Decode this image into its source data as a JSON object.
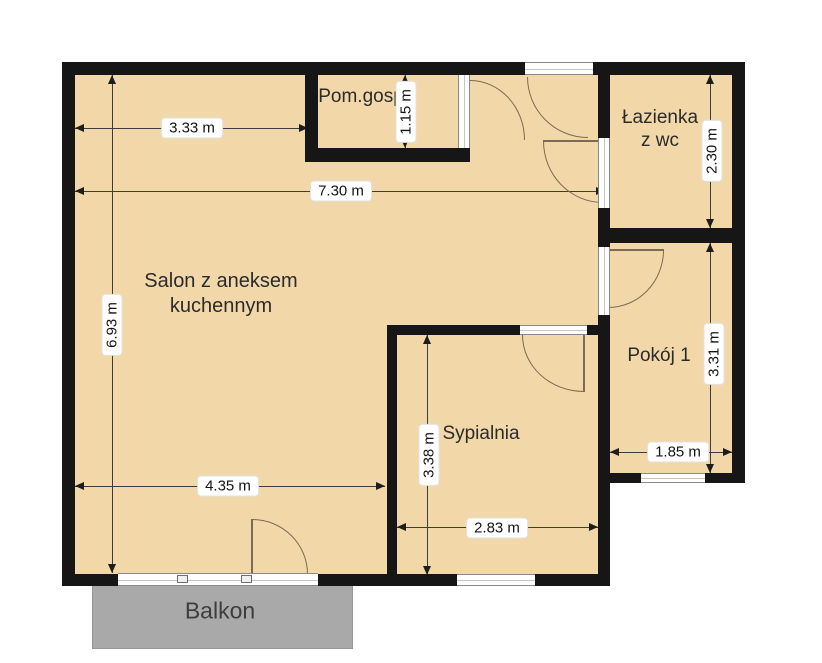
{
  "colors": {
    "floor": "#f2d8a8",
    "wall": "#161616",
    "balcony": "#a9a9a9",
    "window_frame": "#8a8a8a",
    "dimension_line": "#3c3c3c",
    "door_arc": "#7b6a54",
    "label_text": "#141414"
  },
  "rooms": {
    "salon": {
      "label": "Salon z aneksem kuchennym"
    },
    "pom_gosp": {
      "label": "Pom.gosp"
    },
    "lazienka": {
      "label": "Łazienka z wc"
    },
    "pokoj1": {
      "label": "Pokój 1"
    },
    "sypialnia": {
      "label": "Sypialnia"
    },
    "balkon": {
      "label": "Balkon"
    }
  },
  "dimensions": {
    "d333": {
      "label": "3.33 m"
    },
    "d730": {
      "label": "7.30 m"
    },
    "d693": {
      "label": "6.93 m"
    },
    "d435": {
      "label": "4.35 m"
    },
    "d115": {
      "label": "1.15 m"
    },
    "d230": {
      "label": "2.30 m"
    },
    "d331": {
      "label": "3.31 m"
    },
    "d185": {
      "label": "1.85 m"
    },
    "d338": {
      "label": "3.38 m"
    },
    "d283": {
      "label": "2.83 m"
    }
  }
}
